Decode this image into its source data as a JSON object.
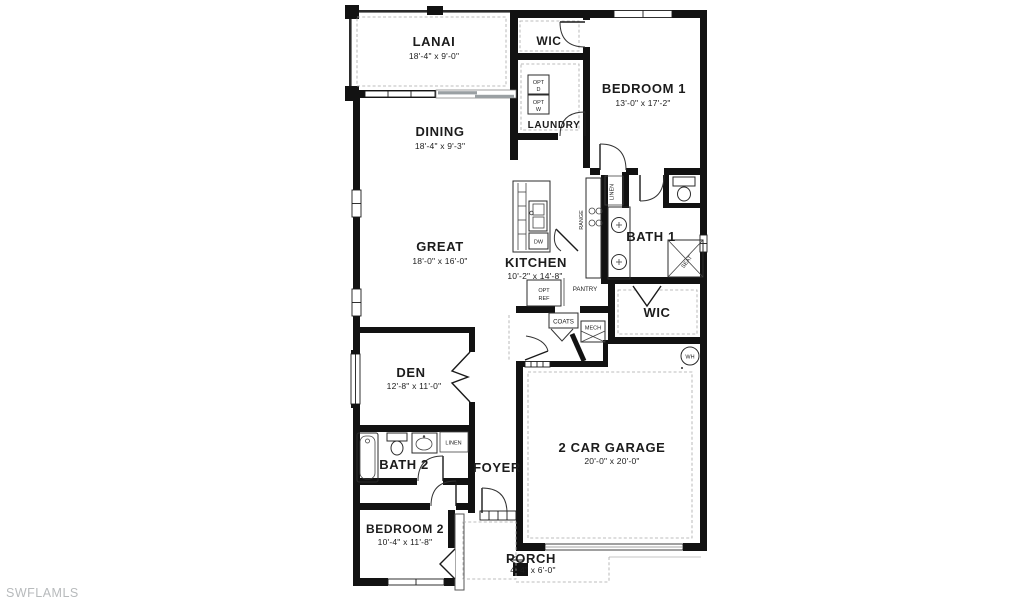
{
  "watermark": "SWFLAMLS",
  "rooms": {
    "lanai": {
      "name": "LANAI",
      "dims": "18'-4\" x 9'-0\""
    },
    "dining": {
      "name": "DINING",
      "dims": "18'-4\" x 9'-3\""
    },
    "great": {
      "name": "GREAT",
      "dims": "18'-0\" x 16'-0\""
    },
    "kitchen": {
      "name": "KITCHEN",
      "dims": "10'-2\" x 14'-8\""
    },
    "bedroom1": {
      "name": "BEDROOM 1",
      "dims": "13'-0\" x 17'-2\""
    },
    "wic_top": {
      "name": "WIC"
    },
    "laundry": {
      "name": "LAUNDRY"
    },
    "bath1": {
      "name": "BATH 1"
    },
    "wic_main": {
      "name": "WIC"
    },
    "den": {
      "name": "DEN",
      "dims": "12'-8\" x 11'-0\""
    },
    "bath2": {
      "name": "BATH 2"
    },
    "foyer": {
      "name": "FOYER"
    },
    "bedroom2": {
      "name": "BEDROOM 2",
      "dims": "10'-4\" x 11'-8\""
    },
    "garage": {
      "name": "2 CAR GARAGE",
      "dims": "20'-0\" x 20'-0\""
    },
    "porch": {
      "name": "PORCH",
      "dims": "4'-4\" x 6'-0\""
    }
  },
  "features": {
    "opt_dryer": {
      "line1": "OPT",
      "line2": "D"
    },
    "opt_washer": {
      "line1": "OPT",
      "line2": "W"
    },
    "opt_ref": {
      "line1": "OPT",
      "line2": "REF"
    },
    "dishwasher": "DW",
    "range": "RANGE",
    "linen_hall": "LINEN",
    "linen_bath2": "LINEN",
    "pantry": "PANTRY",
    "coats": "COATS",
    "mech": "MECH",
    "seat": "SEAT",
    "water_heater": "WH"
  },
  "colors": {
    "walls": "#121212",
    "text": "#1c1c1c",
    "watermark": "#b7babc",
    "slider_gray": "#9aa0a3"
  }
}
